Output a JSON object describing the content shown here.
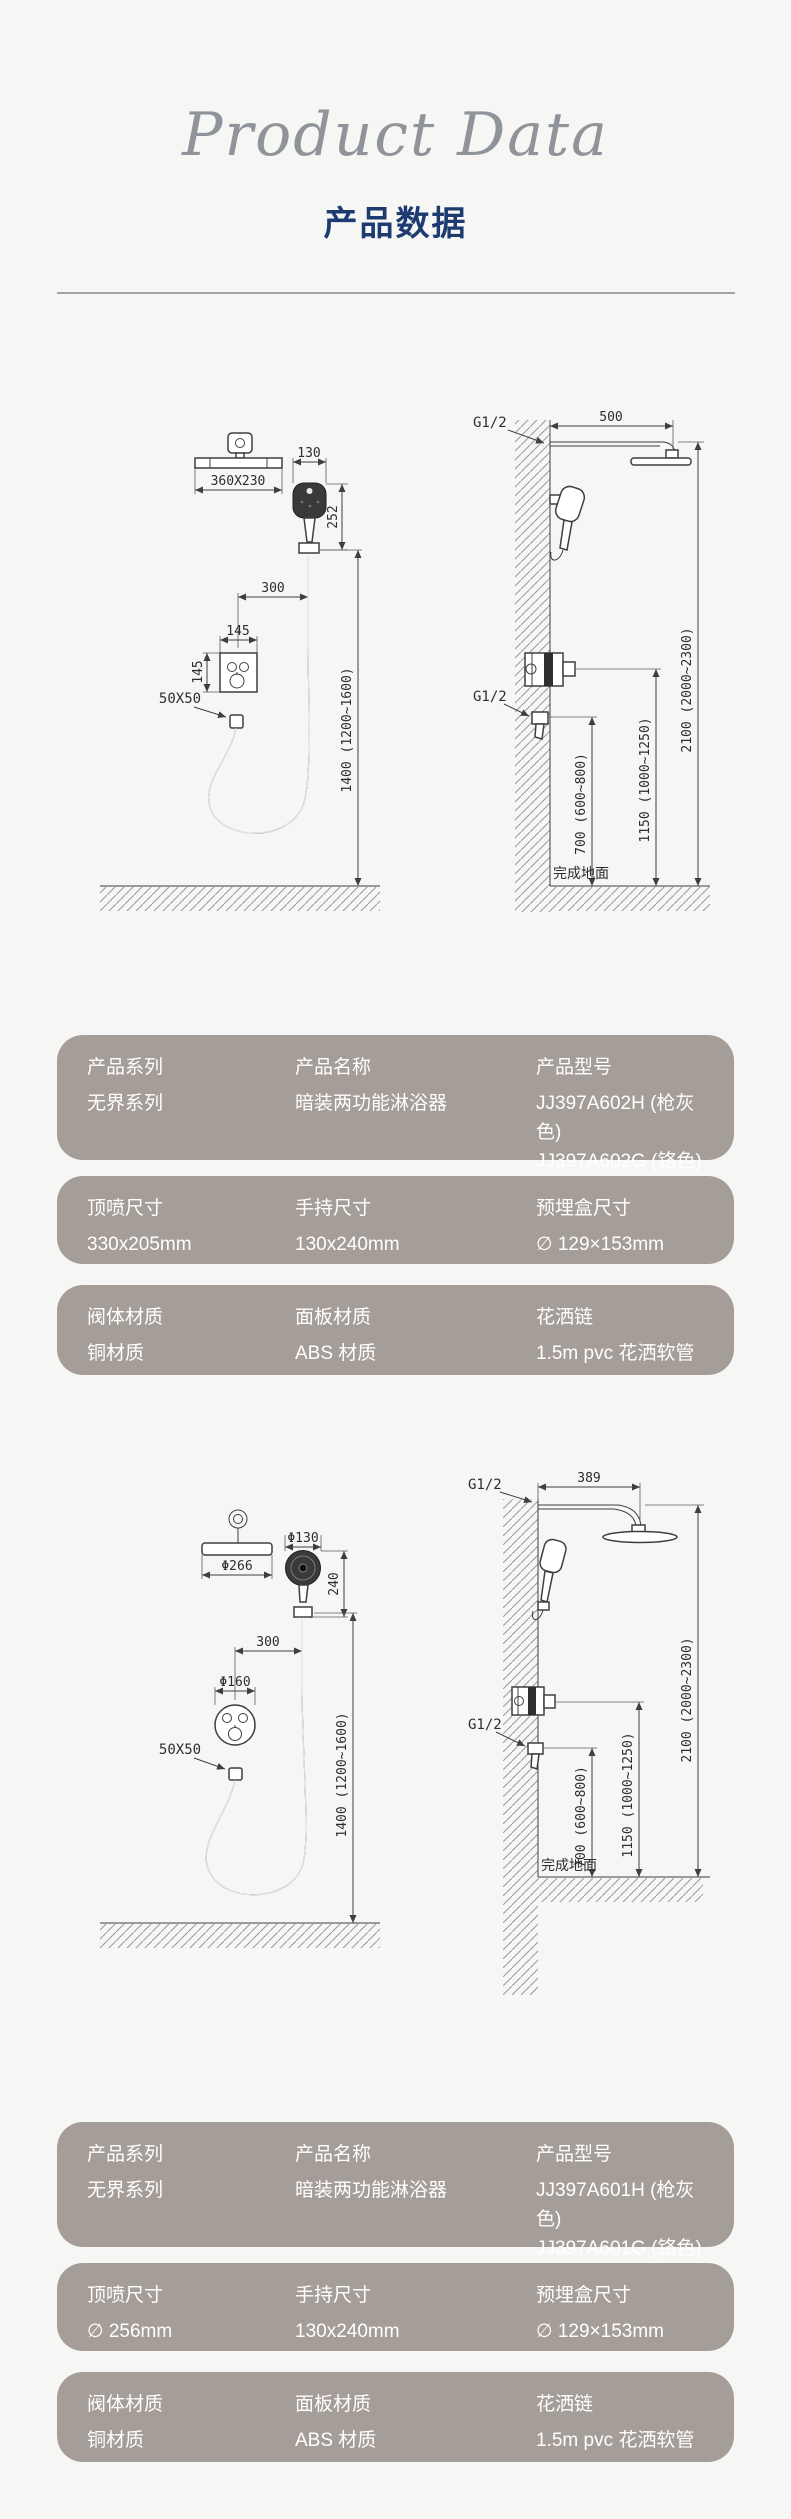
{
  "header": {
    "script_title": "Product Data",
    "title": "产品数据"
  },
  "colors": {
    "title_navy": "#1d3b70",
    "card_bg": "#a59d97",
    "page_bg": "#f6f6f4"
  },
  "drawing1": {
    "left": {
      "plate_dim": "360X230",
      "hand_width": "130",
      "hand_height": "252",
      "offset_dim": "300",
      "valve_width": "145",
      "valve_height": "145",
      "outlet_dim": "50X50",
      "install_height": "1400 (1200~1600)"
    },
    "right": {
      "thread_top": "G1/2",
      "arm_length": "500",
      "total_height": "2100 (2000~2300)",
      "thread_mid": "G1/2",
      "valve_height": "1150 (1000~1250)",
      "outlet_height": "700 (600~800)",
      "floor_label": "完成地面"
    }
  },
  "specs_a": {
    "cards": [
      {
        "cols": [
          {
            "label": "产品系列",
            "values": [
              "无界系列"
            ]
          },
          {
            "label": "产品名称",
            "values": [
              "暗装两功能淋浴器"
            ]
          },
          {
            "label": "产品型号",
            "values": [
              "JJ397A602H (枪灰色)",
              "JJ397A602G (铬色)"
            ]
          }
        ]
      },
      {
        "cols": [
          {
            "label": "顶喷尺寸",
            "values": [
              "330x205mm"
            ]
          },
          {
            "label": "手持尺寸",
            "values": [
              "130x240mm"
            ]
          },
          {
            "label": "预埋盒尺寸",
            "values": [
              "∅ 129×153mm"
            ]
          }
        ]
      },
      {
        "cols": [
          {
            "label": "阀体材质",
            "values": [
              "铜材质"
            ]
          },
          {
            "label": "面板材质",
            "values": [
              "ABS 材质"
            ]
          },
          {
            "label": "花洒链",
            "values": [
              "1.5m pvc 花洒软管"
            ]
          }
        ]
      }
    ]
  },
  "drawing2": {
    "left": {
      "plate_dim": "Φ266",
      "hand_width": "Φ130",
      "hand_height": "240",
      "offset_dim": "300",
      "valve_dim": "Φ160",
      "outlet_dim": "50X50",
      "install_height": "1400 (1200~1600)"
    },
    "right": {
      "thread_top": "G1/2",
      "arm_length": "389",
      "total_height": "2100 (2000~2300)",
      "thread_mid": "G1/2",
      "valve_height": "1150 (1000~1250)",
      "outlet_height": "700 (600~800)",
      "floor_label": "完成地面"
    }
  },
  "specs_b": {
    "cards": [
      {
        "cols": [
          {
            "label": "产品系列",
            "values": [
              "无界系列"
            ]
          },
          {
            "label": "产品名称",
            "values": [
              "暗装两功能淋浴器"
            ]
          },
          {
            "label": "产品型号",
            "values": [
              "JJ397A601H (枪灰色)",
              "JJ397A601G (铬色)"
            ]
          }
        ]
      },
      {
        "cols": [
          {
            "label": "顶喷尺寸",
            "values": [
              "∅ 256mm"
            ]
          },
          {
            "label": "手持尺寸",
            "values": [
              "130x240mm"
            ]
          },
          {
            "label": "预埋盒尺寸",
            "values": [
              "∅ 129×153mm"
            ]
          }
        ]
      },
      {
        "cols": [
          {
            "label": "阀体材质",
            "values": [
              "铜材质"
            ]
          },
          {
            "label": "面板材质",
            "values": [
              "ABS 材质"
            ]
          },
          {
            "label": "花洒链",
            "values": [
              "1.5m pvc 花洒软管"
            ]
          }
        ]
      }
    ]
  }
}
